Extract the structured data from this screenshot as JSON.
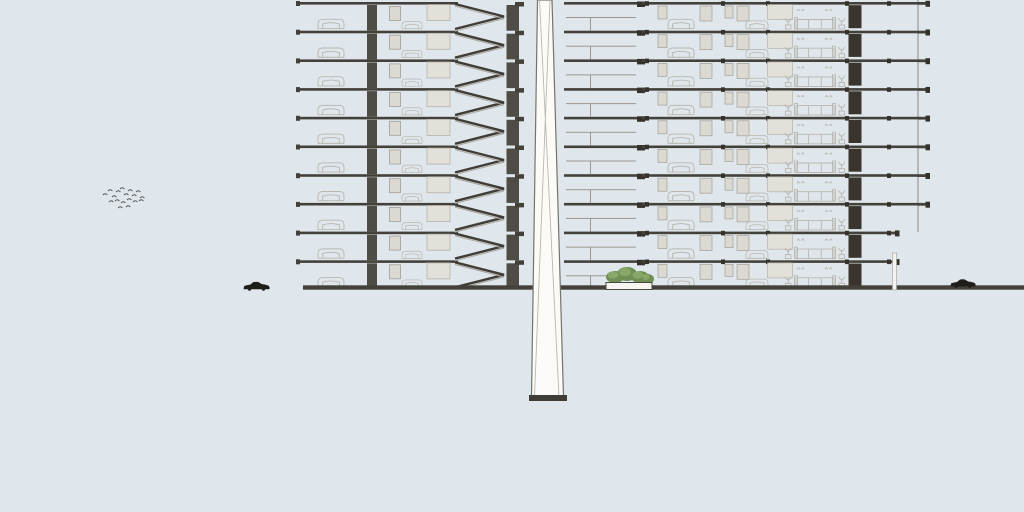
{
  "scene_type": "architectural-cross-section",
  "palette": {
    "sky_top": "#c9dcea",
    "sky_mid": "#dde8ee",
    "sky_low": "#e6ebec",
    "sky_horizon": "#e9e6de",
    "slab_dark": "#44413b",
    "wall_dark": "#4f4c45",
    "nub_dark": "#35322c",
    "line_light": "#c6c4bc",
    "line_mid": "#9b988f",
    "tower_white": "#f8f7f2",
    "bay_white": "#fafaf6",
    "basement_white": "#fcfbf7",
    "door_grey_fill": "#dbd9d1",
    "door_grey_edge": "#a19f97",
    "panel_grey": "#e2e0d9",
    "dark_door": "#39342d",
    "furniture_line": "#b9b7b0",
    "car_black": "#1f1e1b",
    "soil_base": "#b39a8c",
    "soil_dot_dark": "#a0887a",
    "soil_dot_light": "#c2ab9c",
    "grade_line": "#3e3b35",
    "grass_base": "#7a9660",
    "hedge_haze": "#ccdabf",
    "mast_fill": "#fcfbf8",
    "mast_edge": "#76736b",
    "mast_brace": "#bab7af",
    "bird": "#55534f",
    "tree_tones": {
      "light": [
        "#9cb87a",
        "#c6d79f",
        "#7fa05f"
      ],
      "mid": [
        "#85a468",
        "#aabf86",
        "#66854e"
      ],
      "hazy": [
        "#b7c9a6",
        "#cdd9bd",
        "#9fb48c"
      ],
      "dark": [
        "#5d7a4a",
        "#789659",
        "#47603a"
      ]
    },
    "trunk": "#584d3e"
  },
  "scene": {
    "canvas": {
      "w": 1024,
      "h": 512
    },
    "ground_y": 289,
    "floors": {
      "count": 10,
      "pitch": 28.7,
      "cropped_at_top": true
    },
    "left_tower": {
      "x": 305,
      "w": 150,
      "shaft_x": 367,
      "door": [
        389.5,
        11,
        14
      ],
      "panel": [
        427,
        23,
        16
      ],
      "thin_lines": [
        352,
        358,
        380
      ],
      "chairs": [
        [
          314,
          34,
          13
        ],
        [
          399,
          26,
          10
        ]
      ]
    },
    "stair_bay": {
      "x": 455,
      "w": 70,
      "apex_x": 504,
      "shaft_x": 506.5,
      "shaft_w": 12.5,
      "below_levels": [
        [
          289.7,
          332.5
        ],
        [
          336.7,
          364.5
        ],
        [
          368.7,
          395.5
        ]
      ]
    },
    "elevator_core": {
      "x": 564,
      "w": 78,
      "divider_x": 590
    },
    "mast": {
      "top_l": 537.5,
      "top_r": 552,
      "bot_l": 531.5,
      "bot_r": 563.5,
      "bottom_y": 397,
      "base": [
        529,
        395,
        38,
        6
      ]
    },
    "right_tower": {
      "x": 642,
      "w": 246,
      "thin_lines": [
        652,
        722,
        767,
        793,
        846.5
      ],
      "doors_small": [
        [
          658,
          9,
          13
        ],
        [
          700,
          12,
          15
        ],
        [
          725,
          8,
          12
        ],
        [
          737,
          12,
          15
        ]
      ],
      "panel": [
        767.5,
        25,
        15
      ],
      "dark_door": [
        848.5,
        13,
        23
      ],
      "chairs": [
        [
          664,
          34,
          13
        ],
        [
          742,
          30,
          11
        ]
      ],
      "sofa_x": 783,
      "nubs": [
        645,
        721,
        766,
        845,
        887
      ],
      "bay": {
        "x": 888,
        "w": 30,
        "bottom_y": 232
      }
    },
    "basement": {
      "x": 322,
      "right": 1024,
      "top_slab_y": 285.3,
      "slab1_y": 332.5,
      "slab2_y": 364.5,
      "bottom_y": 395.5,
      "left_wall_x": 320,
      "mid_wall_x": 604.5,
      "stair_wall_x": 454.5,
      "ramp": {
        "x": 556,
        "w": 48
      },
      "parking_levels": 3,
      "car_bottoms": [
        332.5,
        364.5,
        395.5
      ]
    },
    "stackers": {
      "top": 302,
      "bottom": 332.5,
      "shelf": 317.5,
      "boxes": [
        {
          "x": 327,
          "w": 36,
          "post": false,
          "cars": [
            [
              330,
              30
            ]
          ]
        },
        {
          "x": 659,
          "w": 101,
          "post": true,
          "cars": [
            [
              663,
              40
            ],
            [
              705,
              40
            ]
          ]
        },
        {
          "x": 817,
          "w": 38,
          "post": false,
          "cars": [
            [
              820,
              32
            ]
          ]
        },
        {
          "x": 883,
          "w": 39,
          "post": false,
          "cars": [
            [
              886,
              32
            ]
          ]
        }
      ]
    },
    "cars": {
      "front": [
        {
          "x": 399,
          "w": 16,
          "levels": [
            0,
            1,
            2
          ]
        },
        {
          "x": 621,
          "w": 18,
          "levels": [
            0,
            1,
            2
          ]
        },
        {
          "x": 781,
          "w": 18,
          "levels": [
            0,
            1,
            2
          ]
        },
        {
          "x": 976,
          "w": 18,
          "levels": [
            0,
            1,
            2
          ]
        }
      ],
      "side": [
        {
          "x": 329,
          "w": 27,
          "levels": [
            1,
            2
          ]
        },
        {
          "x": 728,
          "w": 23,
          "levels": [
            0
          ]
        },
        {
          "x": 857,
          "w": 26,
          "levels": [
            0
          ]
        },
        {
          "x": 662,
          "w": 27,
          "levels": [
            1,
            2
          ]
        },
        {
          "x": 696,
          "w": 27,
          "levels": [
            1,
            2
          ]
        },
        {
          "x": 730,
          "w": 27,
          "levels": [
            1,
            2
          ]
        },
        {
          "x": 822,
          "w": 27,
          "levels": [
            1,
            2
          ]
        },
        {
          "x": 855,
          "w": 27,
          "levels": [
            1,
            2
          ]
        },
        {
          "x": 888,
          "w": 27,
          "levels": [
            1,
            2
          ]
        }
      ],
      "street": [
        {
          "x": 242,
          "y": 280.7,
          "w": 29
        },
        {
          "x": 949,
          "y": 278.2,
          "w": 28
        }
      ]
    },
    "planter": {
      "box": [
        606,
        282.5,
        46,
        7
      ],
      "bushes": [
        [
          615,
          277,
          9,
          6
        ],
        [
          627,
          274,
          10,
          7
        ],
        [
          640,
          277,
          9,
          6
        ],
        [
          648,
          279,
          6,
          5
        ]
      ]
    },
    "landscape": {
      "left": {
        "grass": [
          0,
          281,
          310,
          9.5
        ],
        "hedge": [
          0,
          267,
          308,
          14.5
        ],
        "rail_y": 271,
        "grade_line": [
          0,
          291,
          324,
          4
        ],
        "pole_x": 71
      },
      "right": {
        "grass": [
          897,
          278,
          127,
          11.5
        ],
        "hedge": [
          897,
          267,
          127,
          12
        ],
        "rail_y": 267.5,
        "post": [
          892.5,
          253,
          4,
          37
        ]
      }
    },
    "trees": [
      {
        "x": 198,
        "base": 289,
        "top": 244,
        "r": 20,
        "tone": "hazy"
      },
      {
        "x": 227,
        "base": 289,
        "top": 238,
        "r": 24,
        "tone": "hazy"
      },
      {
        "x": 253,
        "base": 289,
        "top": 242,
        "r": 20,
        "tone": "hazy"
      },
      {
        "x": 16,
        "base": 290,
        "top": 250,
        "r": 20,
        "tone": "dark"
      },
      {
        "x": 45,
        "base": 290,
        "top": 202,
        "r": 32,
        "tone": "mid"
      },
      {
        "x": 128,
        "base": 290,
        "top": 196,
        "r": 50,
        "tone": "light"
      },
      {
        "x": 290,
        "base": 290,
        "top": 228,
        "r": 34,
        "tone": "mid"
      },
      {
        "x": 926,
        "base": 289,
        "top": 228,
        "r": 33,
        "tone": "mid"
      },
      {
        "x": 999,
        "base": 289,
        "top": 224,
        "r": 35,
        "tone": "light"
      }
    ],
    "birds": {
      "base": [
        103,
        189
      ],
      "offsets": [
        [
          0,
          6
        ],
        [
          5,
          2
        ],
        [
          9,
          8
        ],
        [
          13,
          3
        ],
        [
          17,
          0
        ],
        [
          21,
          6
        ],
        [
          25,
          2
        ],
        [
          29,
          7
        ],
        [
          33,
          3
        ],
        [
          37,
          9
        ],
        [
          6,
          13
        ],
        [
          12,
          12
        ],
        [
          18,
          14
        ],
        [
          24,
          11
        ],
        [
          30,
          13
        ],
        [
          36,
          12
        ],
        [
          15,
          19
        ],
        [
          23,
          18
        ]
      ]
    },
    "clouds": [
      [
        140,
        55,
        120,
        26,
        0.5
      ],
      [
        420,
        95,
        160,
        30,
        0.4
      ],
      [
        720,
        50,
        150,
        28,
        0.35
      ],
      [
        260,
        150,
        200,
        30,
        0.3
      ],
      [
        880,
        120,
        130,
        24,
        0.3
      ]
    ]
  }
}
